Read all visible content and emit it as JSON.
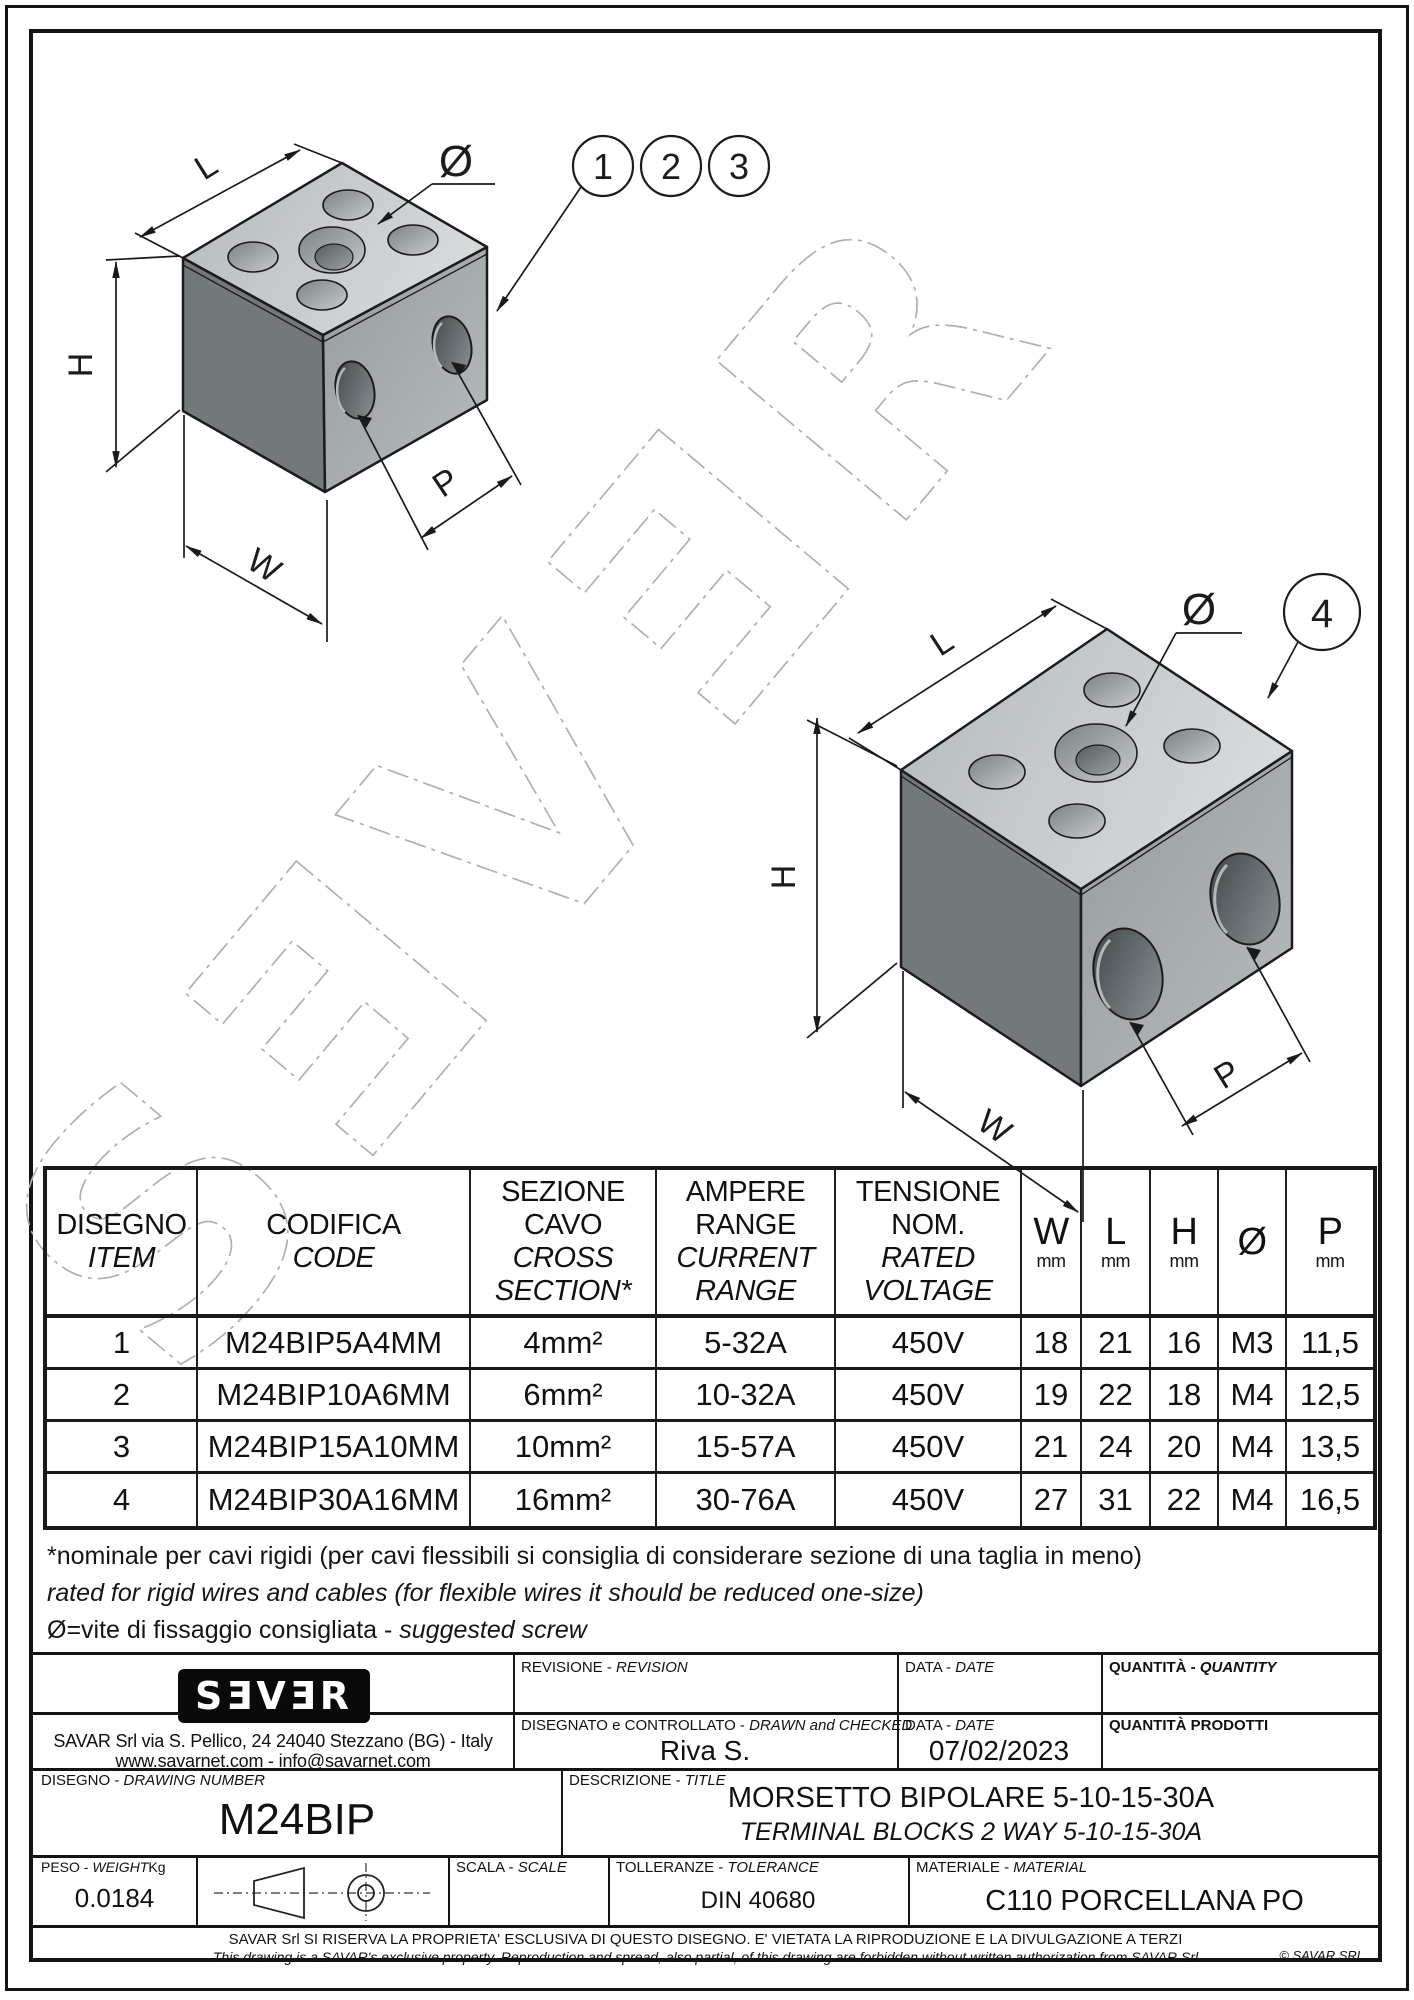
{
  "drawing": {
    "watermark": "SƎVƎR",
    "dim_labels": {
      "l": "L",
      "h": "H",
      "w": "W",
      "p": "P",
      "dia": "Ø"
    },
    "balloons": [
      "1",
      "2",
      "3",
      "4"
    ]
  },
  "table": {
    "header": {
      "item_it": "DISEGNO",
      "item_en": "ITEM",
      "code_it": "CODIFICA",
      "code_en": "CODE",
      "section_it1": "SEZIONE",
      "section_it2": "CAVO",
      "section_en1": "CROSS",
      "section_en2": "SECTION*",
      "ampere_it1": "AMPERE",
      "ampere_it2": "RANGE",
      "ampere_en1": "CURRENT",
      "ampere_en2": "RANGE",
      "voltage_it1": "TENSIONE",
      "voltage_it2": "NOM.",
      "voltage_en1": "RATED",
      "voltage_en2": "VOLTAGE",
      "w": "W",
      "l": "L",
      "h": "H",
      "dia": "Ø",
      "p": "P",
      "mm": "mm"
    },
    "rows": [
      {
        "item": "1",
        "code": "M24BIP5A4MM",
        "section": "4mm²",
        "ampere": "5-32A",
        "voltage": "450V",
        "w": "18",
        "l": "21",
        "h": "16",
        "dia": "M3",
        "p": "11,5"
      },
      {
        "item": "2",
        "code": "M24BIP10A6MM",
        "section": "6mm²",
        "ampere": "10-32A",
        "voltage": "450V",
        "w": "19",
        "l": "22",
        "h": "18",
        "dia": "M4",
        "p": "12,5"
      },
      {
        "item": "3",
        "code": "M24BIP15A10MM",
        "section": "10mm²",
        "ampere": "15-57A",
        "voltage": "450V",
        "w": "21",
        "l": "24",
        "h": "20",
        "dia": "M4",
        "p": "13,5"
      },
      {
        "item": "4",
        "code": "M24BIP30A16MM",
        "section": "16mm²",
        "ampere": "30-76A",
        "voltage": "450V",
        "w": "27",
        "l": "31",
        "h": "22",
        "dia": "M4",
        "p": "16,5"
      }
    ]
  },
  "footnotes": {
    "line1": "*nominale per cavi rigidi (per cavi flessibili si consiglia di considerare sezione di una taglia in meno)",
    "line2": "rated for rigid wires and cables (for flexible wires it should be reduced one-size)",
    "line3_prefix": "Ø=vite di fissaggio consigliata - ",
    "line3_italic": "suggested screw"
  },
  "titleblock": {
    "logo": "SƎVƎR",
    "address1": "SAVAR Srl via S. Pellico, 24  24040 Stezzano (BG) - Italy",
    "address2": "www.savarnet.com  -  info@savarnet.com",
    "labels": {
      "revision_it": "REVISIONE - ",
      "revision_en": "REVISION",
      "date_it": "DATA - ",
      "date_en": "DATE",
      "quantity_it": "QUANTITÀ - ",
      "quantity_en": "QUANTITY",
      "drawn_it": "DISEGNATO e CONTROLLATO - ",
      "drawn_en": "DRAWN and CHECKED",
      "quantity_prod": "QUANTITÀ  PRODOTTI",
      "number_it": "DISEGNO - ",
      "number_en": "DRAWING NUMBER",
      "title_it": "DESCRIZIONE - ",
      "title_en": "TITLE",
      "weight_it": "PESO - ",
      "weight_en": "WEIGHT",
      "weight_unit": "Kg",
      "scale_it": "SCALA - ",
      "scale_en": "SCALE",
      "tolerance_it": "TOLLERANZE - ",
      "tolerance_en": "TOLERANCE",
      "material_it": "MATERIALE - ",
      "material_en": "MATERIAL"
    },
    "values": {
      "drawn_by": "Riva S.",
      "date": "07/02/2023",
      "drawing_number": "M24BIP",
      "description_it": "MORSETTO BIPOLARE 5-10-15-30A",
      "description_en": "TERMINAL BLOCKS 2 WAY 5-10-15-30A",
      "weight": "0.0184",
      "tolerance": "DIN 40680",
      "material": "C110 PORCELLANA PO"
    }
  },
  "disclaimer": {
    "line1": "SAVAR Srl SI RISERVA LA PROPRIETA' ESCLUSIVA DI QUESTO DISEGNO. E' VIETATA LA RIPRODUZIONE E LA DIVULGAZIONE A TERZI",
    "line2": "This drawing is a SAVAR's exclusive property. Reproduction and spread, also partial, of this drawing are forbidden without written authorization from SAVAR Srl",
    "copyright": "© SAVAR SRL"
  }
}
